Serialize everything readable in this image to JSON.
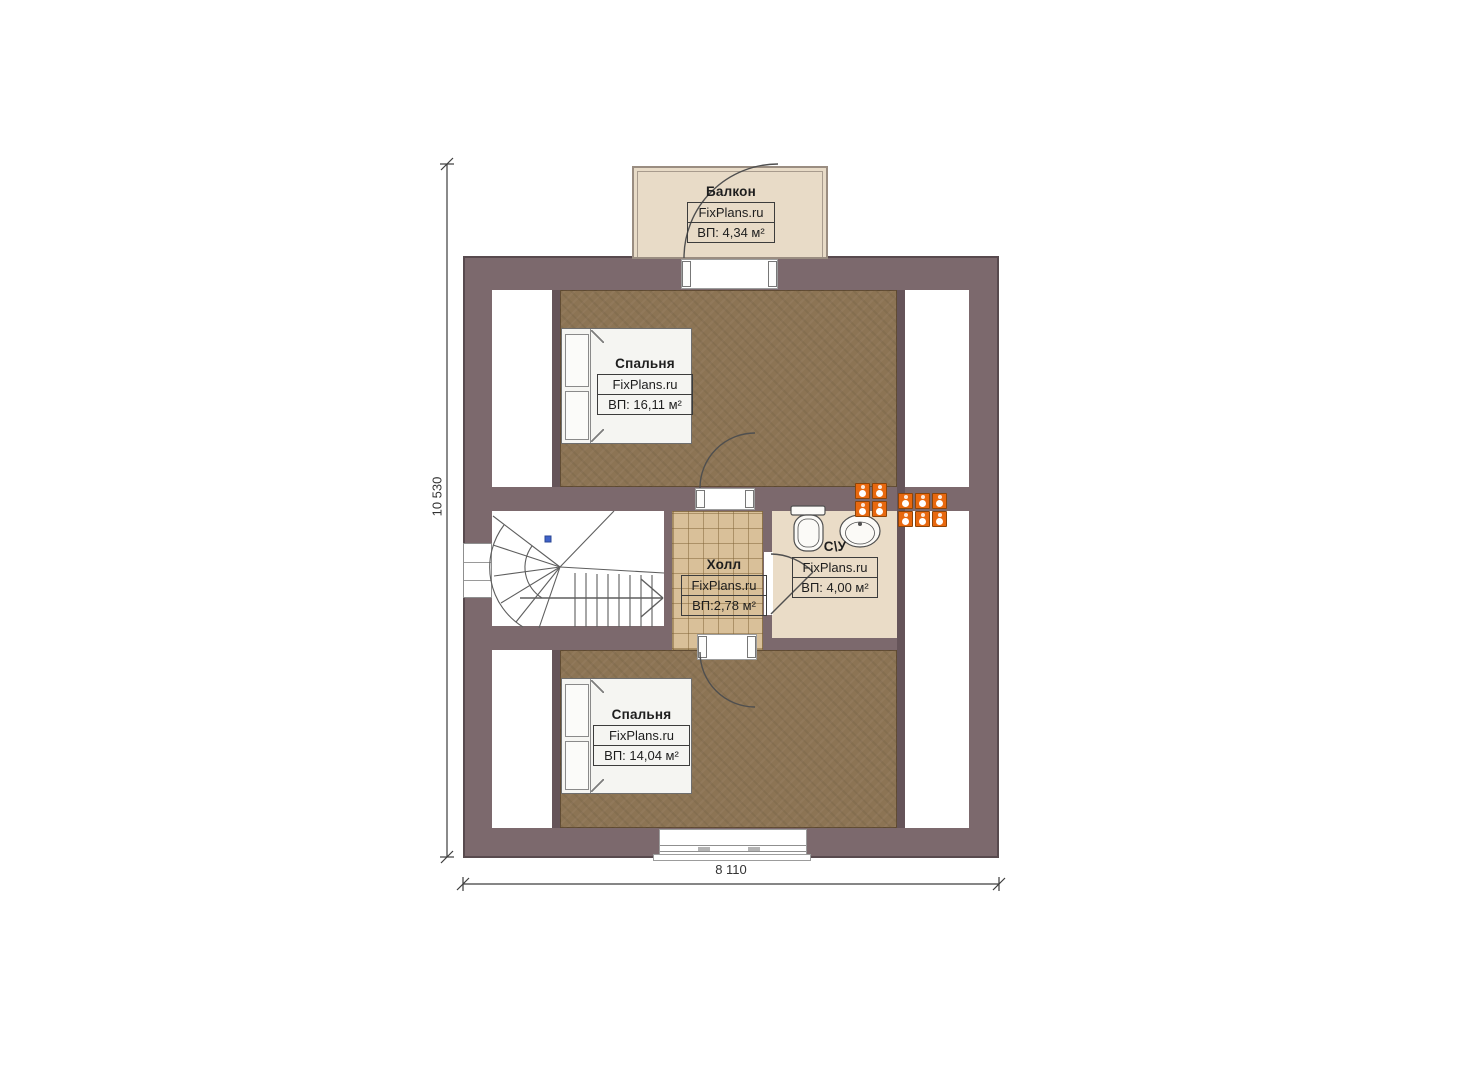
{
  "plan": {
    "title": "FixPlans.ru floor plan",
    "dimensions": {
      "height_label": "10 530",
      "width_label": "8 110"
    },
    "rooms": {
      "balcony": {
        "name": "Балкон",
        "brand": "FixPlans.ru",
        "area": "ВП: 4,34 м²"
      },
      "bedroom_top": {
        "name": "Спальня",
        "brand": "FixPlans.ru",
        "area": "ВП: 16,11 м²"
      },
      "hall": {
        "name": "Холл",
        "brand": "FixPlans.ru",
        "area": "ВП:2,78 м²"
      },
      "bathroom": {
        "name": "С\\У",
        "brand": "FixPlans.ru",
        "area": "ВП: 4,00 м²"
      },
      "bedroom_bottom": {
        "name": "Спальня",
        "brand": "FixPlans.ru",
        "area": "ВП: 14,04 м²"
      }
    },
    "vents": {
      "groups": [
        {
          "cols": 2,
          "rows": 2
        },
        {
          "cols": 3,
          "rows": 2
        }
      ]
    },
    "colors": {
      "wall": "#7c696d",
      "wall_dark": "#655459",
      "bedroom_floor": "#8c7454",
      "hall_tile": "#d9c099",
      "bathroom_floor": "#eadcc7",
      "balcony_floor": "#e8dbc7",
      "vent": "#e8680f",
      "marker_blue": "#3f62c9"
    }
  }
}
